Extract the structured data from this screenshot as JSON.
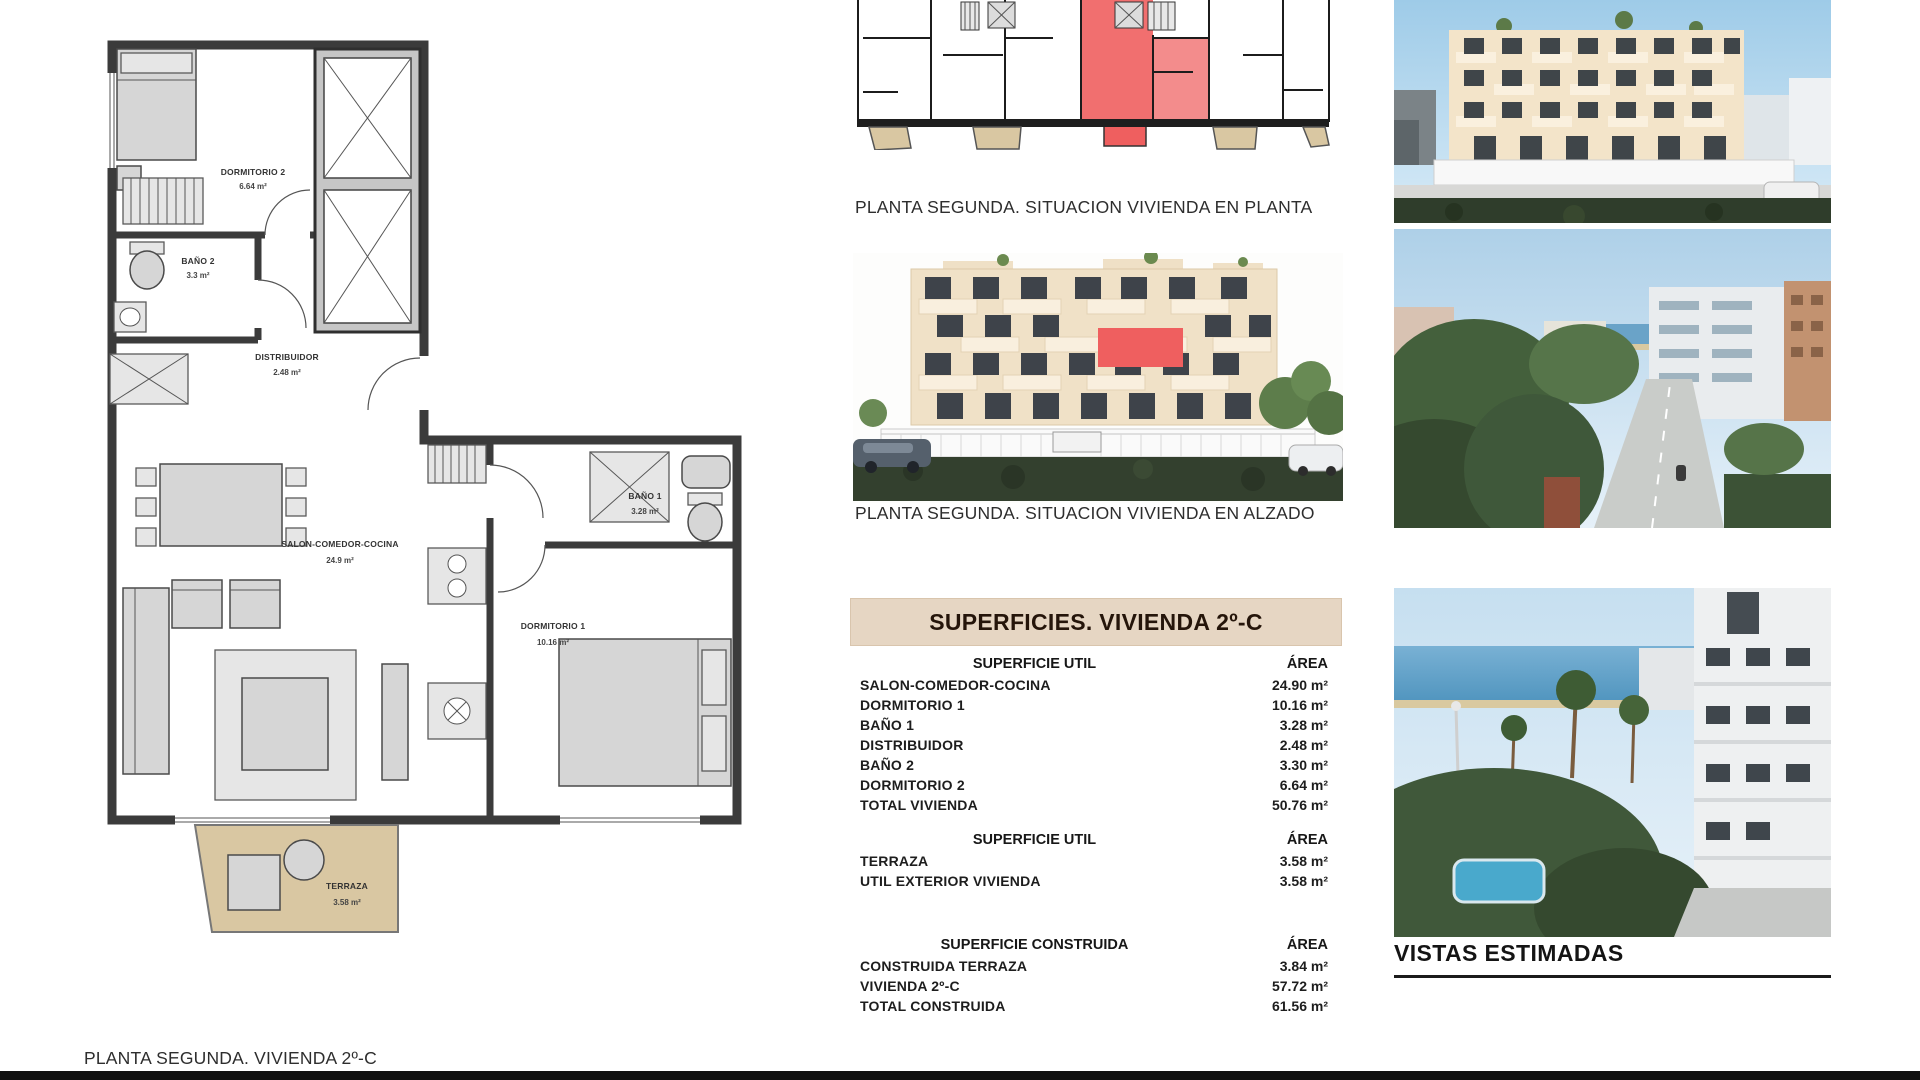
{
  "colors": {
    "banner_bg": "#e6d6c3",
    "highlight_red": "#ef5f5f",
    "terrace_beige": "#d9c7a2"
  },
  "floor_plan": {
    "caption": "PLANTA SEGUNDA. VIVIENDA 2º-C",
    "rooms": [
      {
        "name": "DORMITORIO 2",
        "area": "6.64 m²"
      },
      {
        "name": "BAÑO 2",
        "area": "3.3 m²"
      },
      {
        "name": "DISTRIBUIDOR",
        "area": "2.48 m²"
      },
      {
        "name": "SALON-COMEDOR-COCINA",
        "area": "24.9 m²"
      },
      {
        "name": "BAÑO 1",
        "area": "3.28 m²"
      },
      {
        "name": "DORMITORIO 1",
        "area": "10.16 m²"
      },
      {
        "name": "TERRAZA",
        "area": "3.58 m²"
      }
    ]
  },
  "situation_plan": {
    "caption": "PLANTA SEGUNDA. SITUACION VIVIENDA EN PLANTA"
  },
  "elevation": {
    "caption": "PLANTA SEGUNDA. SITUACION VIVIENDA EN ALZADO"
  },
  "surfaces_table": {
    "title": "SUPERFICIES. VIVIENDA 2º-C",
    "sections": [
      {
        "header": "SUPERFICIE UTIL",
        "area_header": "ÁREA",
        "rows": [
          {
            "label": "SALON-COMEDOR-COCINA",
            "value": "24.90 m²"
          },
          {
            "label": "DORMITORIO 1",
            "value": "10.16 m²"
          },
          {
            "label": "BAÑO 1",
            "value": "3.28 m²"
          },
          {
            "label": "DISTRIBUIDOR",
            "value": "2.48 m²"
          },
          {
            "label": "BAÑO 2",
            "value": "3.30 m²"
          },
          {
            "label": "DORMITORIO 2",
            "value": "6.64 m²"
          },
          {
            "label": "TOTAL VIVIENDA",
            "value": "50.76 m²"
          }
        ]
      },
      {
        "header": "SUPERFICIE UTIL",
        "area_header": "ÁREA",
        "rows": [
          {
            "label": "TERRAZA",
            "value": "3.58 m²"
          },
          {
            "label": "UTIL EXTERIOR VIVIENDA",
            "value": "3.58 m²"
          }
        ]
      },
      {
        "header": "SUPERFICIE CONSTRUIDA",
        "area_header": "ÁREA",
        "rows": [
          {
            "label": "CONSTRUIDA TERRAZA",
            "value": "3.84 m²"
          },
          {
            "label": "VIVIENDA 2º-C",
            "value": "57.72 m²"
          },
          {
            "label": "TOTAL CONSTRUIDA",
            "value": "61.56 m²"
          }
        ]
      }
    ]
  },
  "views": {
    "caption": "VISTAS ESTIMADAS"
  }
}
